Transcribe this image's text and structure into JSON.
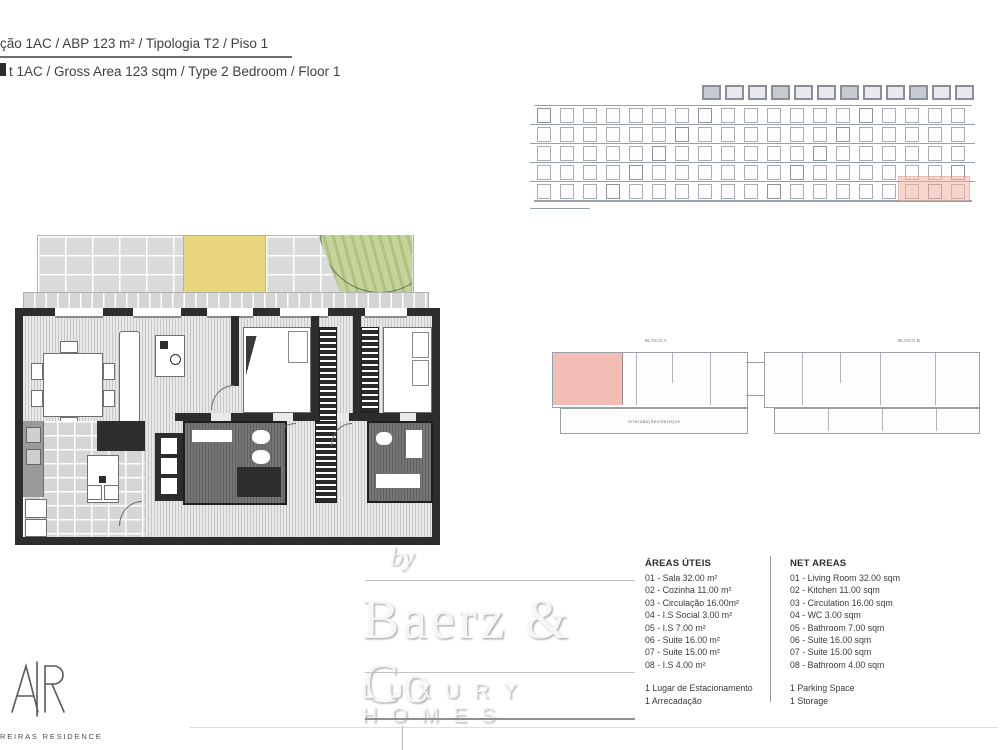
{
  "header": {
    "line1_pt": "ção 1AC  /  ABP 123 m²  /  Tipologia T2  /  Piso 1",
    "line2_en": "t 1AC  /  Gross Area 123 sqm  /  Type 2 Bedroom  /  Floor 1"
  },
  "elevation": {
    "highlight_color": "#eeb3a4"
  },
  "site_plan": {
    "block_a_label": "BLOCO A",
    "block_b_label": "BLOCO B",
    "storage_label": "Arrecadações/Serviços",
    "highlight_color": "#f2bdb4"
  },
  "watermark": {
    "by": "by",
    "name": "Baerz & Co",
    "tagline": "LUXURY HOMES"
  },
  "brand": {
    "monogram": "AR",
    "residence": "REIRAS RESIDENCE"
  },
  "areas_uteis": {
    "title": "ÁREAS ÚTEIS",
    "items": [
      "01 - Sala 32.00 m²",
      "02 - Cozinha 11.00 m²",
      "03 - Circulação 16.00m²",
      "04 - I.S Social 3.00 m²",
      "05 - I.S 7.00 m²",
      "06 - Suite 16.00 m²",
      "07 - Suite 15.00 m²",
      "08 - I.S 4.00 m²"
    ],
    "extras": [
      "1 Lugar de Estacionamento",
      "1 Arrecadação"
    ]
  },
  "net_areas": {
    "title": "NET AREAS",
    "items": [
      "01 - Living Room 32.00 sqm",
      "02 - Kitchen 11.00 sqm",
      "03 - Circulation 16.00 sqm",
      "04 - WC 3.00 sqm",
      "05 - Bathroom 7.00 sqm",
      "06 - Suite 16.00 sqm",
      "07 - Suite 15.00 sqm",
      "08 - Bathroom 4.00 sqm"
    ],
    "extras": [
      "1 Parking Space",
      "1 Storage"
    ]
  }
}
